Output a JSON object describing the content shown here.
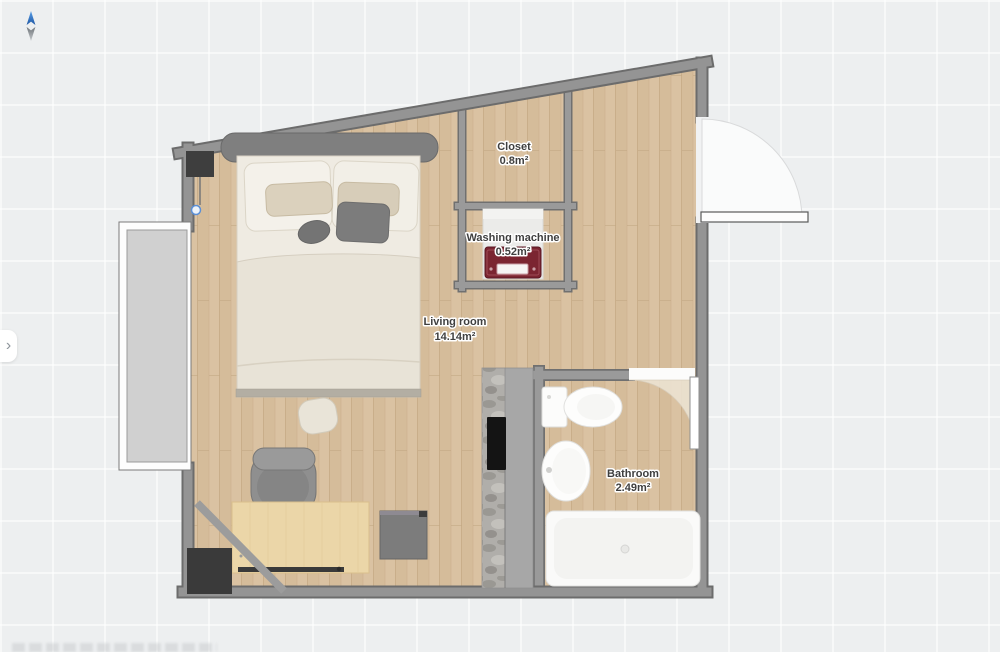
{
  "app": {
    "view": "floor-plan-canvas"
  },
  "icons": {
    "panel_expand": "›",
    "north_arrow": "compass-north-pointer"
  },
  "rooms": [
    {
      "name": "Living room",
      "area": "14.14m²"
    },
    {
      "name": "Closet",
      "area": "0.8m²"
    },
    {
      "name": "Washing machine",
      "area": "0.52m²"
    },
    {
      "name": "Bathroom",
      "area": "2.49m²"
    }
  ],
  "objects": [
    "double-bed",
    "wall-tv",
    "desk",
    "office-chair",
    "side-cabinet",
    "corner-cabinet",
    "kitchen-counter",
    "cooktop",
    "washing-machine",
    "toilet",
    "bathroom-sink",
    "bathtub",
    "balcony-window",
    "entrance-door",
    "bathroom-door"
  ],
  "colors": {
    "canvas_bg": "#edeff0",
    "wood_floor": "#d9c1a1",
    "wall": "#949494",
    "wall_outline": "#6c6c6c",
    "washing_machine_front": "#7b2531",
    "compass_north": "#2e7cd6",
    "desk_wood": "#ebd6a8"
  }
}
